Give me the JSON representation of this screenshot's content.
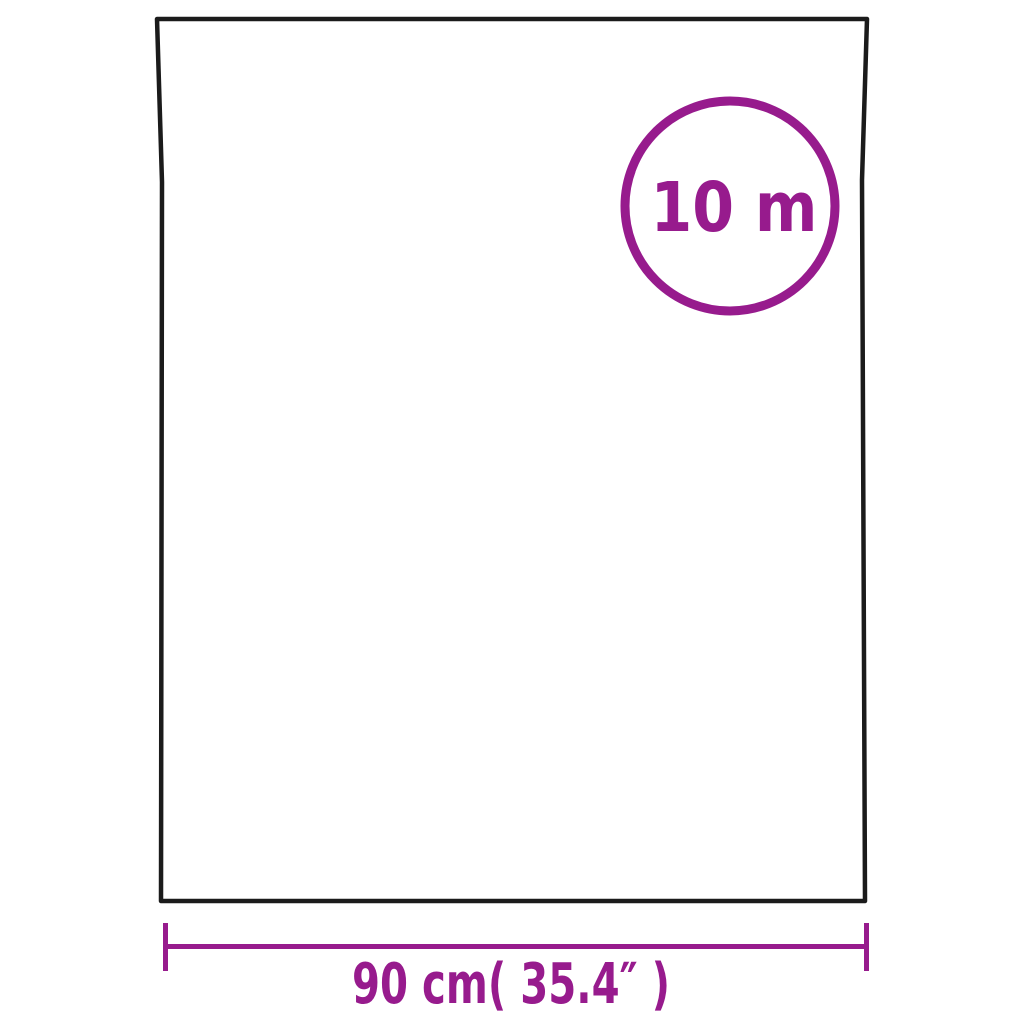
{
  "colors": {
    "background": "#ffffff",
    "outline": "#1b1b1b",
    "accent": "#971b8d"
  },
  "length_badge": {
    "label": "10 m"
  },
  "width_dimension": {
    "label": "90 cm( 35.4″ )"
  }
}
